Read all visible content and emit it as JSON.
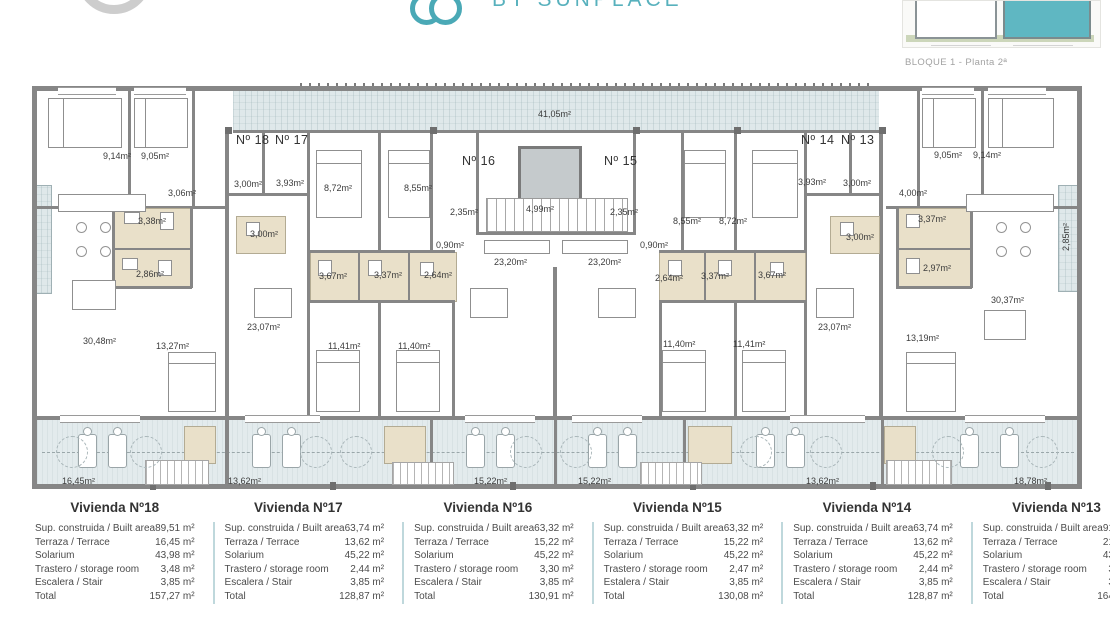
{
  "header": {
    "brand": "BY SUNPLACE",
    "accent_color": "#4aa9b6"
  },
  "siteplan": {
    "caption": "BLOQUE 1 - Planta 2ª",
    "highlight_color": "#5fb7c2"
  },
  "plan": {
    "unit_labels": [
      {
        "t": "Nº 18",
        "x": 236,
        "y": 140
      },
      {
        "t": "Nº 17",
        "x": 275,
        "y": 140
      },
      {
        "t": "Nº 16",
        "x": 462,
        "y": 161
      },
      {
        "t": "Nº 15",
        "x": 604,
        "y": 161
      },
      {
        "t": "Nº 14",
        "x": 801,
        "y": 140
      },
      {
        "t": "Nº 13",
        "x": 841,
        "y": 140
      }
    ],
    "room_labels": [
      {
        "t": "9,14m²",
        "x": 103,
        "y": 156
      },
      {
        "t": "9,05m²",
        "x": 141,
        "y": 156
      },
      {
        "t": "3,06m²",
        "x": 168,
        "y": 193
      },
      {
        "t": "3,38m²",
        "x": 138,
        "y": 221
      },
      {
        "t": "2,86m²",
        "x": 136,
        "y": 274
      },
      {
        "t": "30,48m²",
        "x": 83,
        "y": 341
      },
      {
        "t": "13,27m²",
        "x": 156,
        "y": 346
      },
      {
        "t": "3,00m²",
        "x": 234,
        "y": 184
      },
      {
        "t": "3,93m²",
        "x": 276,
        "y": 183
      },
      {
        "t": "8,72m²",
        "x": 324,
        "y": 188
      },
      {
        "t": "8,55m²",
        "x": 404,
        "y": 188
      },
      {
        "t": "3,00m²",
        "x": 250,
        "y": 234
      },
      {
        "t": "3,67m²",
        "x": 319,
        "y": 276
      },
      {
        "t": "3,37m²",
        "x": 374,
        "y": 275
      },
      {
        "t": "2,64m²",
        "x": 424,
        "y": 275
      },
      {
        "t": "23,07m²",
        "x": 247,
        "y": 327
      },
      {
        "t": "11,41m²",
        "x": 328,
        "y": 346
      },
      {
        "t": "11,40m²",
        "x": 398,
        "y": 346
      },
      {
        "t": "41,05m²",
        "x": 538,
        "y": 114
      },
      {
        "t": "2,35m²",
        "x": 450,
        "y": 212
      },
      {
        "t": "4,99m²",
        "x": 526,
        "y": 209
      },
      {
        "t": "2,35m²",
        "x": 610,
        "y": 212
      },
      {
        "t": "0,90m²",
        "x": 436,
        "y": 245
      },
      {
        "t": "0,90m²",
        "x": 640,
        "y": 245
      },
      {
        "t": "23,20m²",
        "x": 494,
        "y": 262
      },
      {
        "t": "23,20m²",
        "x": 588,
        "y": 262
      },
      {
        "t": "8,55m²",
        "x": 673,
        "y": 221
      },
      {
        "t": "8,72m²",
        "x": 719,
        "y": 221
      },
      {
        "t": "2,64m²",
        "x": 655,
        "y": 278
      },
      {
        "t": "3,37m²",
        "x": 701,
        "y": 276
      },
      {
        "t": "3,67m²",
        "x": 758,
        "y": 275
      },
      {
        "t": "23,07m²",
        "x": 818,
        "y": 327
      },
      {
        "t": "11,40m²",
        "x": 663,
        "y": 344
      },
      {
        "t": "11,41m²",
        "x": 733,
        "y": 344
      },
      {
        "t": "3,93m²",
        "x": 798,
        "y": 182
      },
      {
        "t": "3,00m²",
        "x": 843,
        "y": 183
      },
      {
        "t": "9,05m²",
        "x": 934,
        "y": 155
      },
      {
        "t": "9,14m²",
        "x": 973,
        "y": 155
      },
      {
        "t": "4,00m²",
        "x": 899,
        "y": 193
      },
      {
        "t": "3,37m²",
        "x": 918,
        "y": 219
      },
      {
        "t": "3,00m²",
        "x": 846,
        "y": 237
      },
      {
        "t": "2,97m²",
        "x": 923,
        "y": 268
      },
      {
        "t": "13,19m²",
        "x": 906,
        "y": 338
      },
      {
        "t": "30,37m²",
        "x": 991,
        "y": 300
      }
    ],
    "terrace_labels": [
      {
        "t": "16,45m²",
        "x": 62,
        "y": 481
      },
      {
        "t": "13,62m²",
        "x": 228,
        "y": 481
      },
      {
        "t": "15,22m²",
        "x": 474,
        "y": 481
      },
      {
        "t": "15,22m²",
        "x": 578,
        "y": 481
      },
      {
        "t": "13,62m²",
        "x": 806,
        "y": 481
      },
      {
        "t": "18,78m²",
        "x": 1014,
        "y": 481
      }
    ],
    "rotated_labels": [
      {
        "t": "2,85m²",
        "x": 1066,
        "y": 237,
        "rot": true
      }
    ]
  },
  "tables": {
    "items": [
      {
        "title": "Vivienda Nº18",
        "rows": [
          [
            "Sup. construida / Built area",
            "89,51 m²"
          ],
          [
            "Terraza / Terrace",
            "16,45 m²"
          ],
          [
            "Solarium",
            "43,98 m²"
          ],
          [
            "Trastero / storage room",
            "3,48 m²"
          ],
          [
            "Escalera / Stair",
            "3,85 m²"
          ],
          [
            "Total",
            "157,27 m²"
          ]
        ]
      },
      {
        "title": "Vivienda Nº17",
        "rows": [
          [
            "Sup. construida / Built area",
            "63,74 m²"
          ],
          [
            "Terraza / Terrace",
            "13,62 m²"
          ],
          [
            "Solarium",
            "45,22 m²"
          ],
          [
            "Trastero / storage room",
            "2,44 m²"
          ],
          [
            "Escalera / Stair",
            "3,85 m²"
          ],
          [
            "Total",
            "128,87 m²"
          ]
        ]
      },
      {
        "title": "Vivienda Nº16",
        "rows": [
          [
            "Sup. construida / Built area",
            "63,32 m²"
          ],
          [
            "Terraza / Terrace",
            "15,22 m²"
          ],
          [
            "Solarium",
            "45,22 m²"
          ],
          [
            "Trastero / storage room",
            "3,30 m²"
          ],
          [
            "Escalera / Stair",
            "3,85 m²"
          ],
          [
            "Total",
            "130,91 m²"
          ]
        ]
      },
      {
        "title": "Vivienda Nº15",
        "rows": [
          [
            "Sup. construida / Built area",
            "63,32 m²"
          ],
          [
            "Terraza / Terrace",
            "15,22 m²"
          ],
          [
            "Solarium",
            "45,22 m²"
          ],
          [
            "Trastero / storage room",
            "2,47 m²"
          ],
          [
            "Estalera / Stair",
            "3,85 m²"
          ],
          [
            "Total",
            "130,08 m²"
          ]
        ]
      },
      {
        "title": "Vivienda Nº14",
        "rows": [
          [
            "Sup. construida / Built area",
            "63,74 m²"
          ],
          [
            "Terraza / Terrace",
            "13,62 m²"
          ],
          [
            "Solarium",
            "45,22 m²"
          ],
          [
            "Trastero / storage room",
            "2,44 m²"
          ],
          [
            "Escalera / Stair",
            "3,85 m²"
          ],
          [
            "Total",
            "128,87 m²"
          ]
        ]
      },
      {
        "title": "Vivienda Nº13",
        "rows": [
          [
            "Sup. construida / Built area",
            "91,39 m²"
          ],
          [
            "Terraza / Terrace",
            "21,63 m²"
          ],
          [
            "Solarium",
            "43,98 m²"
          ],
          [
            "Trastero / storage room",
            "3,48 m²"
          ],
          [
            "Escalera / Stair",
            "3,85 m²"
          ],
          [
            "Total",
            "164,33 m²"
          ]
        ]
      }
    ]
  }
}
